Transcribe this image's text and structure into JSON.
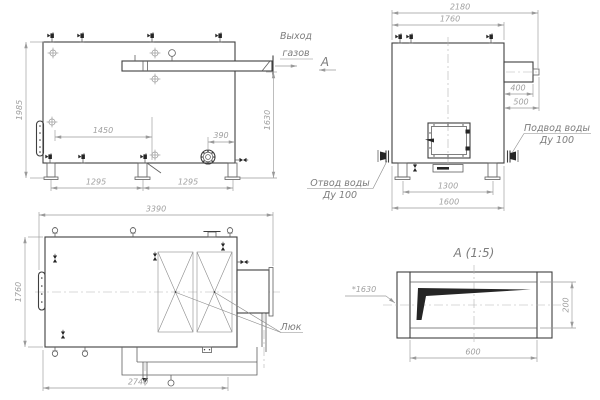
{
  "front_view": {
    "dim_height": "1985",
    "dim_outlet_height": "1630",
    "dim_burner_offset": "1450",
    "dim_flange_offset": "390",
    "dim_leg_left": "1295",
    "dim_leg_right": "1295",
    "label_gas_outlet_1": "Выход",
    "label_gas_outlet_2": "газов",
    "label_section": "А"
  },
  "side_view": {
    "dim_overall": "2180",
    "dim_body": "1760",
    "dim_duct": "400",
    "dim_stub": "500",
    "dim_legs": "1300",
    "dim_base": "1600",
    "label_inlet_1": "Подвод воды",
    "label_inlet_2": "Ду 100",
    "label_outlet_1": "Отвод воды",
    "label_outlet_2": "Ду 100"
  },
  "top_view": {
    "dim_overall": "3390",
    "dim_width": "1760",
    "dim_pipe": "2740",
    "label_hatch": "Люк"
  },
  "detail_view": {
    "title": "А (1:5)",
    "dim_ref": "*1630",
    "dim_width": "600",
    "dim_height": "200"
  },
  "colors": {
    "line": "#3f3f3f",
    "dimension": "#9a9a9a",
    "label": "#7d7d7d",
    "background": "#ffffff"
  }
}
